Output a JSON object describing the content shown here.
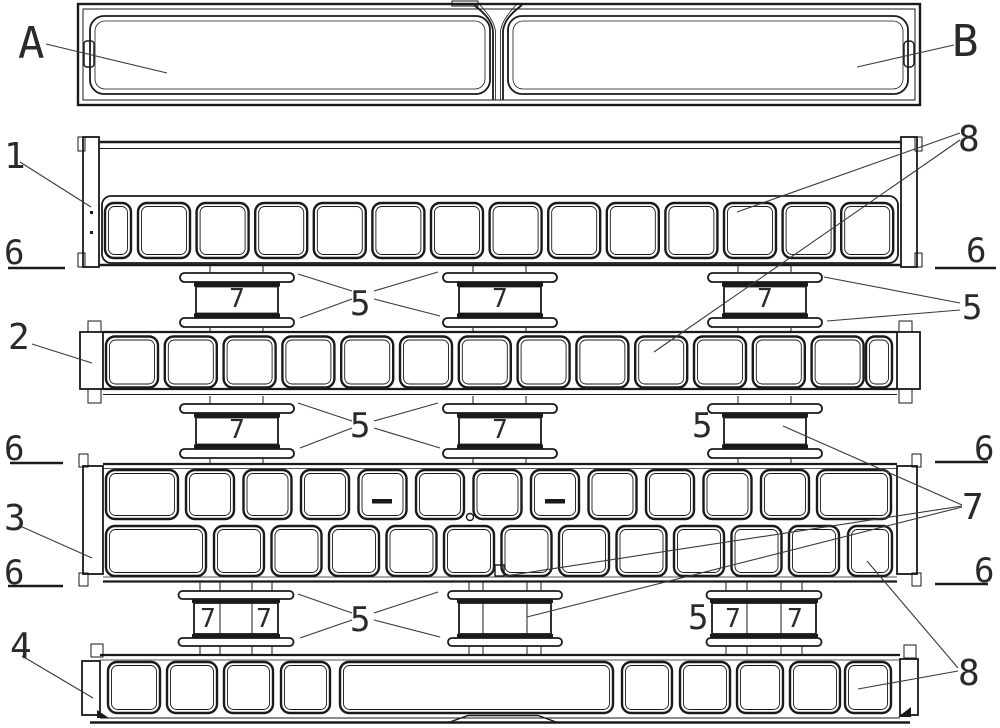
{
  "callouts": {
    "view_a": "A",
    "view_b": "B",
    "beam1": "1",
    "beam2": "2",
    "beam3": "3",
    "beam4": "4",
    "spacer": "5",
    "section": "6",
    "spool": "7",
    "cell": "8"
  },
  "structure": {
    "beam1_windows": 14,
    "beam2_windows": 14,
    "beam3_top_windows": 13,
    "beam3_bottom_windows": 13,
    "beam4_windows": 10,
    "spool_gaps": 3,
    "spools_per_row": 3
  },
  "colors": {
    "line": "#1a1a1a",
    "background": "#ffffff",
    "leader": "#3a3a3a"
  }
}
